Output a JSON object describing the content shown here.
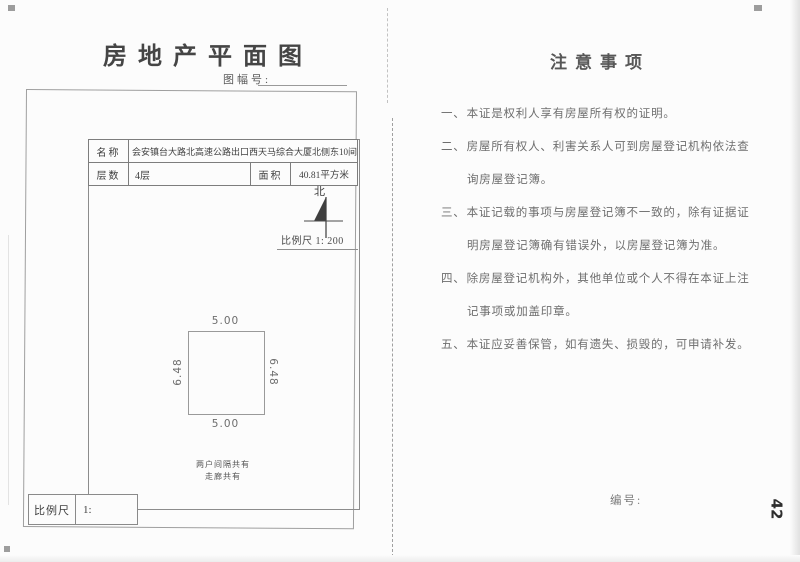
{
  "doc": {
    "left": {
      "title": "房地产平面图",
      "sheet_label": "图幅号:",
      "table": {
        "name_label": "名称",
        "name_value": "会安镇台大路北高速公路出口西天马综合大厦北侧东10间",
        "floors_label": "层数",
        "floors_value": "4层",
        "area_label": "面积",
        "area_value": "40.81平方米"
      },
      "north_label": "北",
      "scale_note": "比例尺 1: 200",
      "plan": {
        "dim_top": "5.00",
        "dim_bottom": "5.00",
        "dim_left": "6.48",
        "dim_right": "6.48",
        "note_line1": "两户间隔共有",
        "note_line2": "走廊共有"
      },
      "scale_bar_label": "比例尺",
      "scale_bar_value": "1:"
    },
    "right": {
      "title": "注意事项",
      "notes": [
        {
          "num": "一、",
          "lines": [
            "本证是权利人享有房屋所有权的证明。"
          ]
        },
        {
          "num": "二、",
          "lines": [
            "房屋所有权人、利害关系人可到房屋登记机构依法查",
            "询房屋登记簿。"
          ]
        },
        {
          "num": "三、",
          "lines": [
            "本证记载的事项与房屋登记簿不一致的，除有证据证",
            "明房屋登记簿确有错误外，以房屋登记簿为准。"
          ]
        },
        {
          "num": "四、",
          "lines": [
            "除房屋登记机构外，其他单位或个人不得在本证上注",
            "记事项或加盖印章。"
          ]
        },
        {
          "num": "五、",
          "lines": [
            "本证应妥善保管，如有遗失、损毁的，可申请补发。"
          ]
        }
      ],
      "serial_label": "编号:",
      "page_number": "42"
    }
  },
  "colors": {
    "ink": "#4a4a4a",
    "line": "#8f8f8f",
    "faded_ink": "#6e6e6e"
  }
}
